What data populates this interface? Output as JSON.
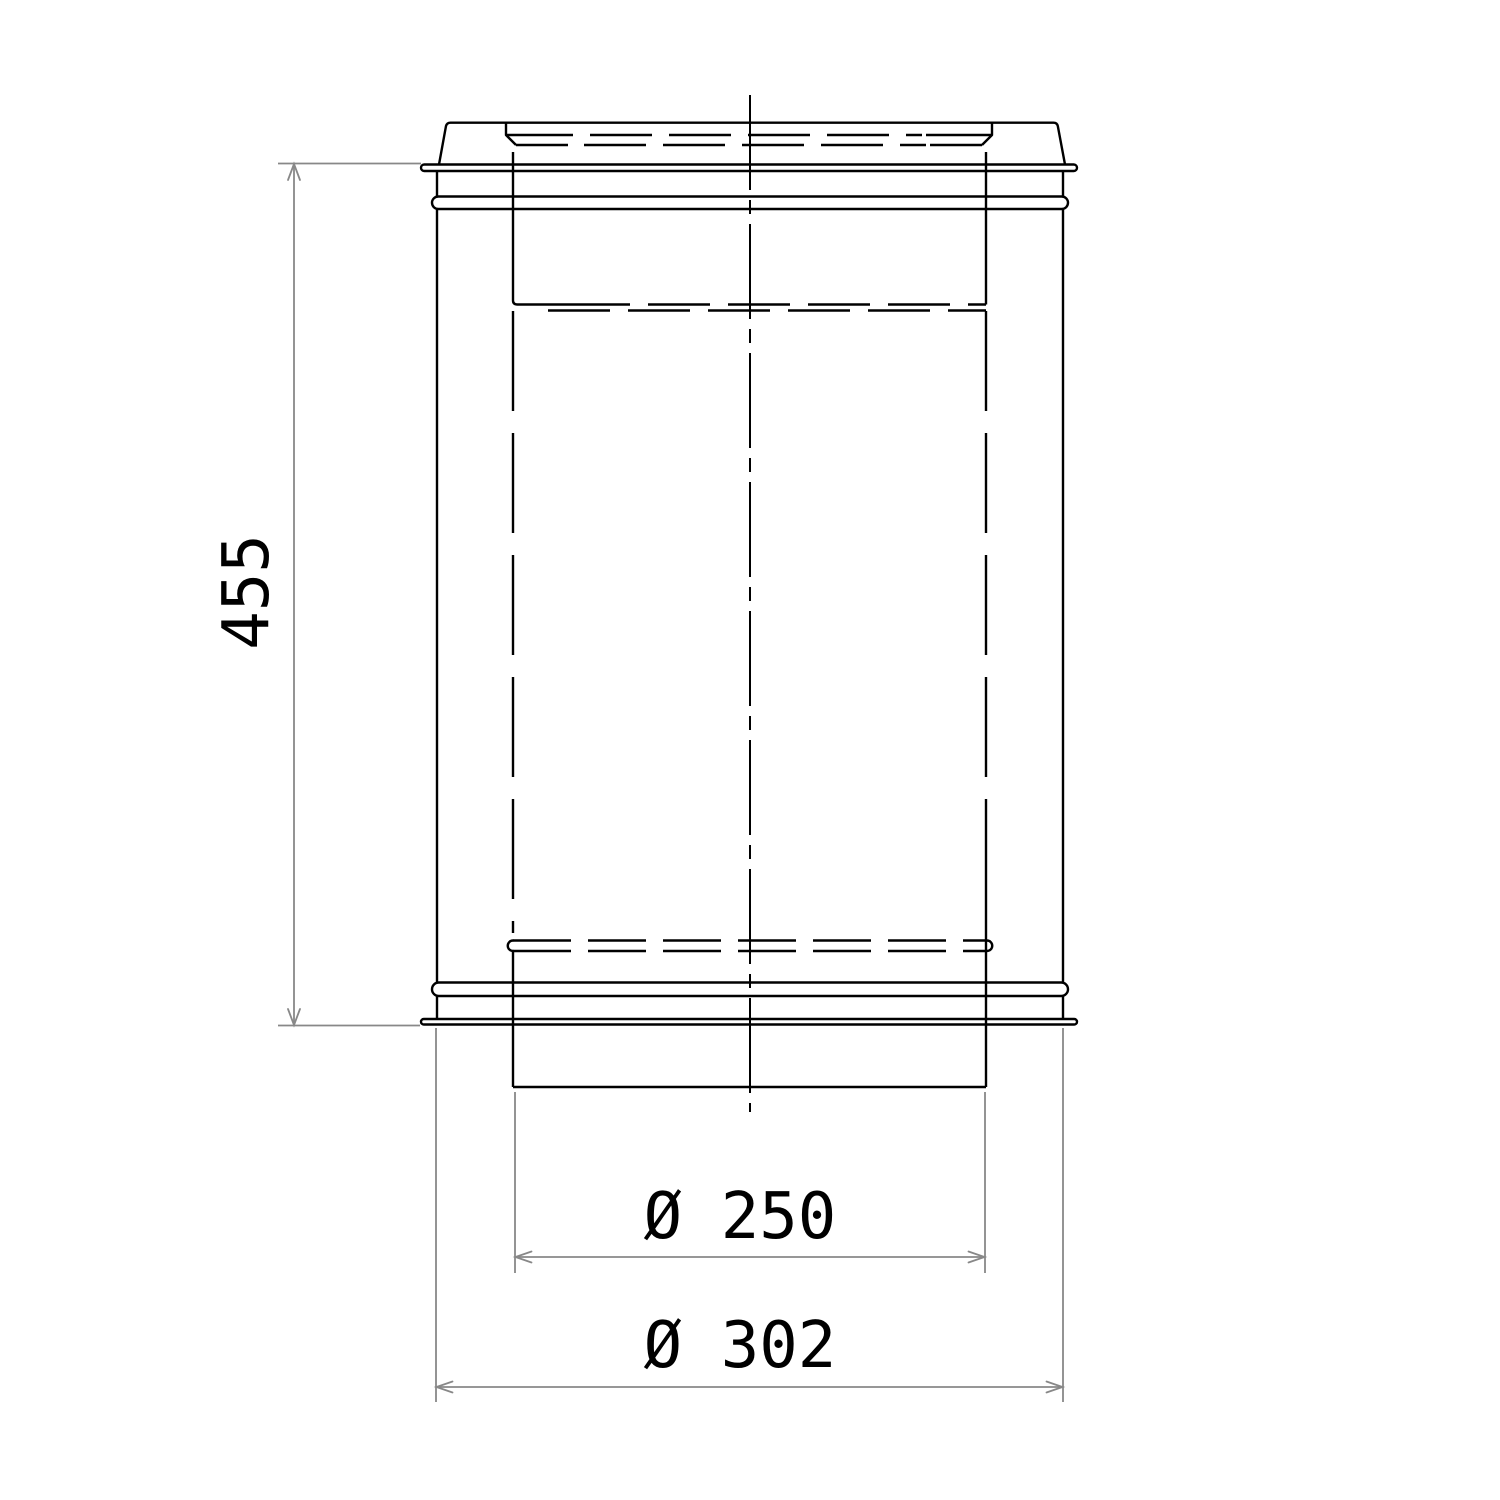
{
  "drawing": {
    "dimensions": {
      "length": {
        "label": "455"
      },
      "inner_diameter": {
        "label": "Ø 250"
      },
      "outer_diameter": {
        "label": "Ø 302"
      }
    },
    "colors": {
      "outline": "#000000",
      "dimension_lines": "#888888",
      "background": "#ffffff"
    }
  }
}
